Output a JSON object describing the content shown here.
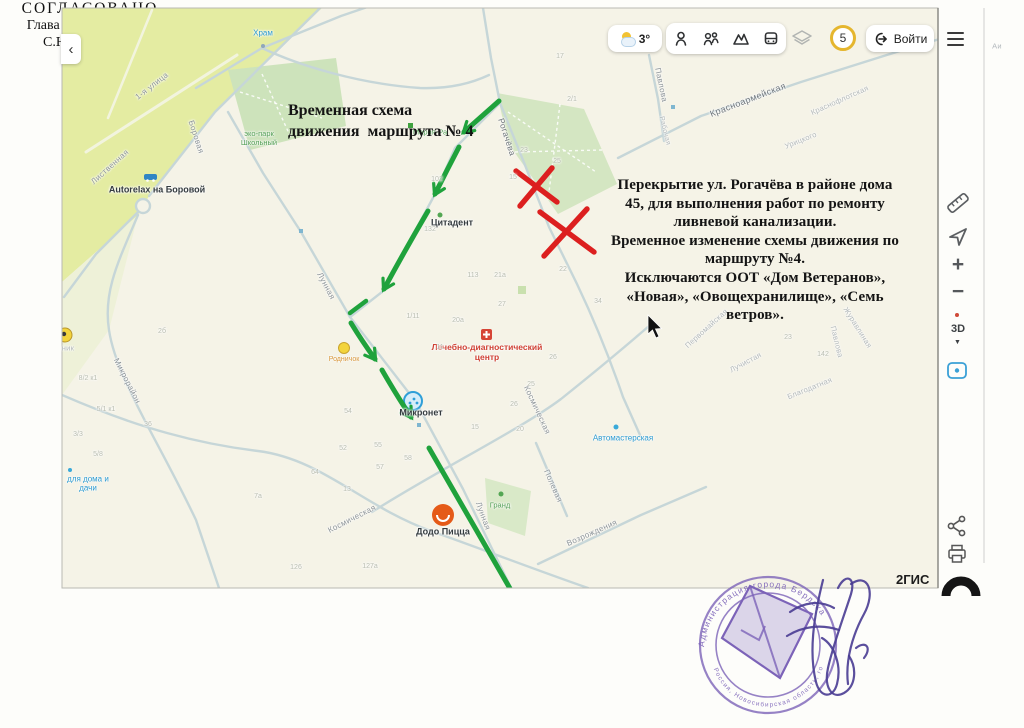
{
  "colors": {
    "map_bg": "#f5f3e7",
    "street": "#c6d6d8",
    "route_green": "#1fa23c",
    "closure_red": "#dc1f1f",
    "stamp_purple": "#7c63b8",
    "badge_yellow": "#e5b62e",
    "poi_blue": "#2a9ad0",
    "poi_green": "#55a058",
    "poi_red": "#cf3f33"
  },
  "toolbar": {
    "collapse_chevron": "‹",
    "weather_temp": "3°",
    "zone_badge": "5",
    "login_label": "Войти"
  },
  "map_controls": {
    "zoom_in": "+",
    "zoom_out": "−",
    "mode_3d": "3D"
  },
  "annotations": {
    "title": "Временная схема\nдвижения  маршрута № 4",
    "body": "Перекрытие ул. Рогачёва в районе дома\n45, для выполнения работ по ремонту\nливневой канализации.\nВременное изменение схемы движения по\nмаршруту №4.\nИсключаются ООТ «Дом Ветеранов»,\n«Новая», «Овощехранилище», «Семь\nветров»."
  },
  "approval": {
    "status": "СОГЛАСОВАНО",
    "role": "Глава города Бердска",
    "name": "С.Ю. Лапицкий"
  },
  "logo": {
    "partial_text": "2ГИС"
  },
  "stamp": {
    "ring_top": "Администрация города Бердска",
    "ring_bottom": "Россия, Новосибирская область, город Бердск"
  },
  "map": {
    "labels": [
      {
        "t": "1-я улица",
        "x": 152,
        "y": 86,
        "r": -38,
        "c": "street"
      },
      {
        "t": "Боровая",
        "x": 196,
        "y": 137,
        "r": 72,
        "c": "street"
      },
      {
        "t": "Лиственная",
        "x": 110,
        "y": 167,
        "r": -42,
        "c": "street"
      },
      {
        "t": "Рогачёва",
        "x": 507,
        "y": 137,
        "r": 72,
        "c": "street-dark"
      },
      {
        "t": "Лунная",
        "x": 326,
        "y": 286,
        "r": 62,
        "c": "street"
      },
      {
        "t": "Микрорайон",
        "x": 127,
        "y": 381,
        "r": 63,
        "c": "street"
      },
      {
        "t": "Космическая",
        "x": 352,
        "y": 519,
        "r": -27,
        "c": "street"
      },
      {
        "t": "Космическая",
        "x": 537,
        "y": 410,
        "r": 65,
        "c": "street"
      },
      {
        "t": "Лунная",
        "x": 483,
        "y": 516,
        "r": 70,
        "c": "street"
      },
      {
        "t": "Полевая",
        "x": 553,
        "y": 486,
        "r": 66,
        "c": "street"
      },
      {
        "t": "Возрождения",
        "x": 592,
        "y": 533,
        "r": -24,
        "c": "street"
      },
      {
        "t": "Красноармейская",
        "x": 748,
        "y": 100,
        "r": -21,
        "c": "street-dark",
        "s": 9
      },
      {
        "t": "Павлова",
        "x": 661,
        "y": 85,
        "r": 78,
        "c": "street"
      },
      {
        "t": "Рабочая",
        "x": 664,
        "y": 131,
        "r": 76,
        "c": "faint",
        "s": 7
      },
      {
        "t": "Краснофлотская",
        "x": 840,
        "y": 101,
        "r": -24,
        "c": "faint"
      },
      {
        "t": "Урицкого",
        "x": 801,
        "y": 141,
        "r": -22,
        "c": "faint"
      },
      {
        "t": "Первомайская",
        "x": 707,
        "y": 329,
        "r": -42,
        "c": "faint"
      },
      {
        "t": "Журавлиная",
        "x": 857,
        "y": 328,
        "r": 58,
        "c": "faint"
      },
      {
        "t": "Павлова",
        "x": 836,
        "y": 342,
        "r": 76,
        "c": "faint"
      },
      {
        "t": "Лучистая",
        "x": 746,
        "y": 363,
        "r": -28,
        "c": "faint"
      },
      {
        "t": "Благодатная",
        "x": 810,
        "y": 389,
        "r": -22,
        "c": "faint"
      },
      {
        "t": "Храм",
        "x": 263,
        "y": 33,
        "r": 0,
        "c": "blue",
        "n": "poi-label-hram"
      },
      {
        "t": "эко-парк\nШкольный",
        "x": 259,
        "y": 139,
        "r": 0,
        "c": "green",
        "n": "poi-label-eco-park"
      },
      {
        "t": "Autorelax на Боровой",
        "x": 157,
        "y": 190,
        "r": 0,
        "c": "dark",
        "n": "poi-label-autorelax"
      },
      {
        "t": "Мария-Ра",
        "x": 430,
        "y": 133,
        "r": 0,
        "c": "green",
        "n": "poi-label-mariya-ra"
      },
      {
        "t": "Цитадент",
        "x": 452,
        "y": 223,
        "r": 0,
        "c": "dark",
        "n": "poi-label-tsitadent"
      },
      {
        "t": "Лечебно-диагностический\nцентр",
        "x": 487,
        "y": 352,
        "r": 0,
        "c": "red",
        "n": "poi-label-med-center"
      },
      {
        "t": "Микронет",
        "x": 421,
        "y": 413,
        "r": 0,
        "c": "dark",
        "n": "poi-label-mikronet"
      },
      {
        "t": "Родничок",
        "x": 344,
        "y": 360,
        "r": 0,
        "c": "orange",
        "n": "poi-label-rodnichok"
      },
      {
        "t": "Додо Пицца",
        "x": 443,
        "y": 532,
        "r": 0,
        "c": "dark",
        "n": "poi-label-dodo"
      },
      {
        "t": "Гранд",
        "x": 500,
        "y": 506,
        "r": 0,
        "c": "green",
        "n": "poi-label-grand"
      },
      {
        "t": "Автомастерская",
        "x": 623,
        "y": 438,
        "r": 0,
        "c": "blue",
        "n": "poi-label-avtomasterskaya"
      },
      {
        "t": "для дома и\nдачи",
        "x": 88,
        "y": 484,
        "r": 0,
        "c": "blue",
        "n": "poi-label-dlya-doma"
      },
      {
        "t": "ник",
        "x": 68,
        "y": 349,
        "r": 0,
        "c": "faint"
      },
      {
        "t": "Аи",
        "x": 997,
        "y": 47,
        "r": 0,
        "c": "faint"
      }
    ],
    "house_numbers": [
      {
        "t": "17",
        "x": 560,
        "y": 57
      },
      {
        "t": "2/1",
        "x": 572,
        "y": 100
      },
      {
        "t": "25",
        "x": 557,
        "y": 162
      },
      {
        "t": "23",
        "x": 524,
        "y": 151
      },
      {
        "t": "15",
        "x": 513,
        "y": 178
      },
      {
        "t": "102",
        "x": 437,
        "y": 180
      },
      {
        "t": "132",
        "x": 430,
        "y": 230
      },
      {
        "t": "1/11",
        "x": 413,
        "y": 317
      },
      {
        "t": "20а",
        "x": 458,
        "y": 321
      },
      {
        "t": "27",
        "x": 502,
        "y": 305
      },
      {
        "t": "21а",
        "x": 500,
        "y": 276
      },
      {
        "t": "113",
        "x": 473,
        "y": 276
      },
      {
        "t": "22",
        "x": 563,
        "y": 270
      },
      {
        "t": "11",
        "x": 440,
        "y": 348
      },
      {
        "t": "26",
        "x": 553,
        "y": 358
      },
      {
        "t": "25",
        "x": 531,
        "y": 385
      },
      {
        "t": "26",
        "x": 514,
        "y": 405
      },
      {
        "t": "15",
        "x": 475,
        "y": 428
      },
      {
        "t": "54",
        "x": 348,
        "y": 412
      },
      {
        "t": "55",
        "x": 378,
        "y": 446
      },
      {
        "t": "8/2 к1",
        "x": 88,
        "y": 379
      },
      {
        "t": "5/1 к1",
        "x": 106,
        "y": 410
      },
      {
        "t": "3/3",
        "x": 78,
        "y": 435
      },
      {
        "t": "5/8",
        "x": 98,
        "y": 455
      },
      {
        "t": "52",
        "x": 343,
        "y": 449
      },
      {
        "t": "58",
        "x": 408,
        "y": 459
      },
      {
        "t": "64",
        "x": 315,
        "y": 473
      },
      {
        "t": "57",
        "x": 380,
        "y": 468
      },
      {
        "t": "13",
        "x": 347,
        "y": 490
      },
      {
        "t": "7а",
        "x": 258,
        "y": 497
      },
      {
        "t": "126",
        "x": 296,
        "y": 568
      },
      {
        "t": "127а",
        "x": 370,
        "y": 567
      },
      {
        "t": "36",
        "x": 148,
        "y": 425
      },
      {
        "t": "2б",
        "x": 162,
        "y": 332
      },
      {
        "t": "20",
        "x": 520,
        "y": 430
      },
      {
        "t": "34",
        "x": 598,
        "y": 302
      },
      {
        "t": "23",
        "x": 788,
        "y": 338
      },
      {
        "t": "142",
        "x": 823,
        "y": 355
      }
    ]
  }
}
